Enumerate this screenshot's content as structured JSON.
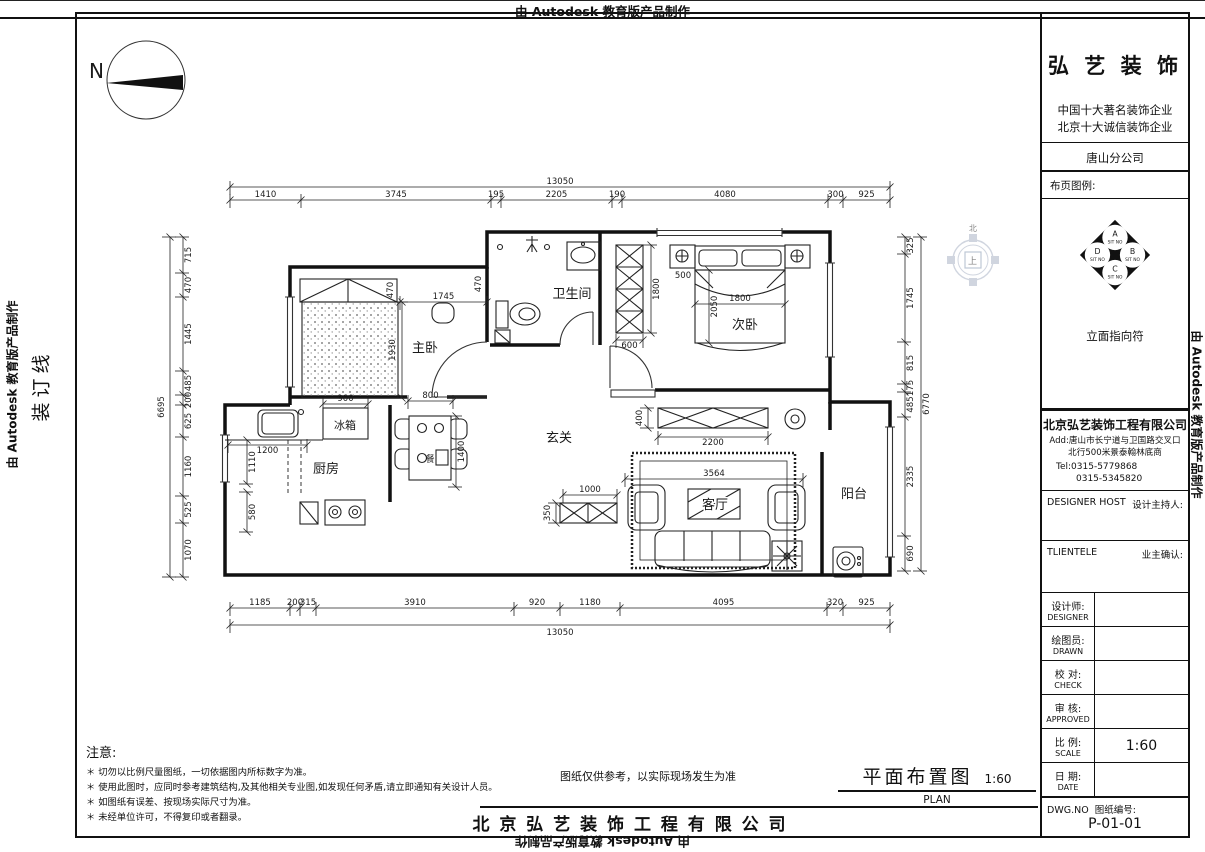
{
  "banner": {
    "autodesk": "由 Autodesk 教育版产品制作",
    "binding_line": "装订线"
  },
  "compass": {
    "label": "N"
  },
  "direction_symbol": {
    "north": "北",
    "center": "上"
  },
  "title_block": {
    "logo": "弘 艺 装 饰",
    "slogan_line1": "中国十大著名装饰企业",
    "slogan_line2": "北京十大诚信装饰企业",
    "branch": "唐山分公司",
    "legend_label": "布页图例:",
    "elevation_symbol": {
      "label": "立面指向符",
      "a": "A",
      "b": "B",
      "c": "C",
      "d": "D",
      "sit": "SIT NO"
    },
    "company": "北京弘艺装饰工程有限公司",
    "address_line1": "Add:唐山市长宁道与卫国路交叉口",
    "address_line2": "北行500米景泰翰林底商",
    "tel_line1": "Tel:0315-5779868",
    "tel_line2": "0315-5345820",
    "designer_host_en": "DESIGNER HOST",
    "designer_host_cn": "设计主持人:",
    "clientele_en": "TLIENTELE",
    "clientele_cn": "业主确认:",
    "rows": [
      {
        "cn": "设计师:",
        "en": "DESIGNER",
        "value": ""
      },
      {
        "cn": "绘图员:",
        "en": "DRAWN",
        "value": ""
      },
      {
        "cn": "校  对:",
        "en": "CHECK",
        "value": ""
      },
      {
        "cn": "审  核:",
        "en": "APPROVED",
        "value": ""
      },
      {
        "cn": "比  例:",
        "en": "SCALE",
        "value": "1:60"
      },
      {
        "cn": "日  期:",
        "en": "DATE",
        "value": ""
      }
    ],
    "dwg_label_en": "DWG.NO",
    "dwg_label_cn": "图纸编号:",
    "dwg_no": "P-01-01"
  },
  "notes": {
    "title": "注意:",
    "items": [
      "＊ 切勿以比例尺量图纸，一切依据图内所标数字为准。",
      "＊ 使用此图时，应同时参考建筑结构,及其他相关专业图,如发现任何矛盾,请立即通知有关设计人员。",
      "＊ 如图纸有误差、按现场实际尺寸为准。",
      "＊ 未经单位许可，不得复印或者翻录。"
    ]
  },
  "footer": {
    "disclaimer": "图纸仅供参考，以实际现场发生为准",
    "title": "平面布置图",
    "scale": "1:60",
    "title_en": "PLAN",
    "company": "北 京 弘 艺 装 饰 工 程 有 限 公 司"
  },
  "plan": {
    "rooms": {
      "master": "主卧",
      "second": "次卧",
      "bathroom": "卫生间",
      "foyer": "玄关",
      "kitchen": "厨房",
      "fridge": "冰箱",
      "living": "客厅",
      "balcony": "阳台",
      "dining_table": "餐"
    },
    "dims": {
      "top_total": "13050",
      "top": [
        "1410",
        "3745",
        "195",
        "2205",
        "190",
        "4080",
        "300",
        "925"
      ],
      "bottom_total": "13050",
      "bottom": [
        "1185",
        "200",
        "315",
        "3910",
        "920",
        "1180",
        "4095",
        "320",
        "925"
      ],
      "left_total": "6695",
      "left": [
        "715",
        "470",
        "1445",
        "485",
        "200",
        "625",
        "1160",
        "525",
        "1070"
      ],
      "right_total": "6770",
      "right": [
        "325",
        "1745",
        "815",
        "175",
        "485",
        "2335",
        "690"
      ],
      "master_470_a": "470",
      "master_470_b": "470",
      "master_gap": "1745",
      "master_bed": "1930",
      "fridge_w": "900",
      "dining_w": "800",
      "kitchen_counter": "1200",
      "kitchen_w": "1110",
      "kitchen_s": "580",
      "dining_l": "1400",
      "second_offset": "500",
      "wardrobe_len": "1800",
      "second_bed_len": "2050",
      "second_bed_w": "1800",
      "wardrobe_depth": "600",
      "tv_depth": "400",
      "tv_len": "2200",
      "rug_w": "3564",
      "shoe_w": "1000",
      "shoe_d": "350"
    }
  }
}
